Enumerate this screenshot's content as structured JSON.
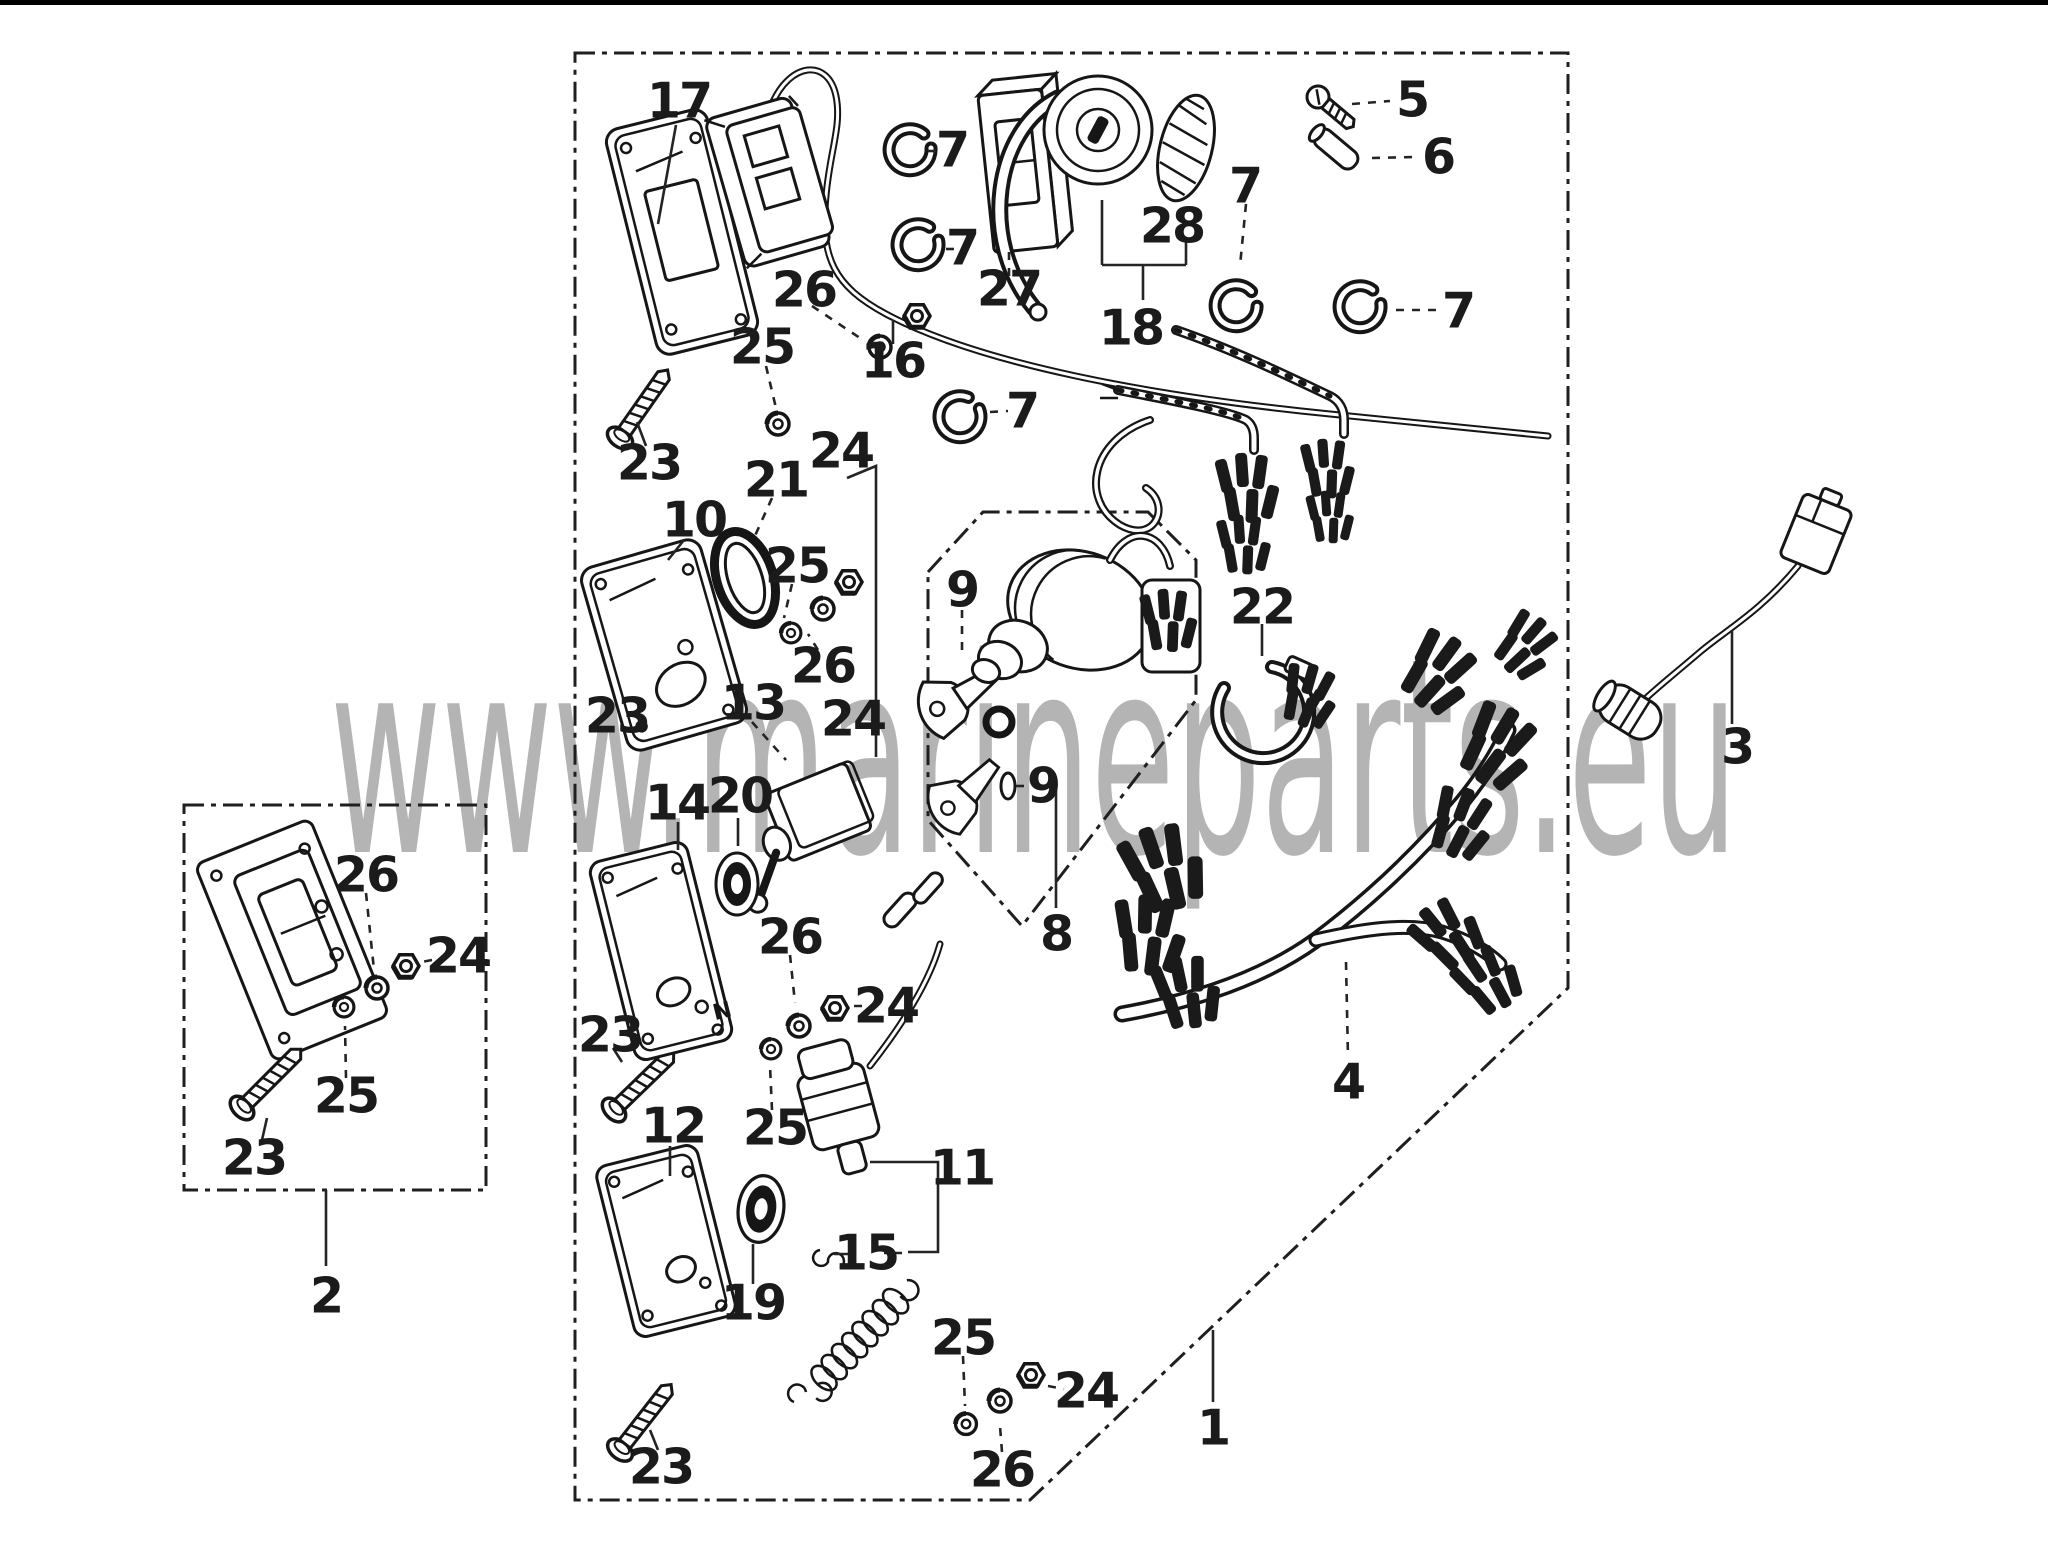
{
  "watermark": {
    "text": "www.marineparts.eu",
    "color": "#b4b4b4"
  },
  "canvas": {
    "background": "#ffffff",
    "line_color": "#161616",
    "width": 2048,
    "height": 1550
  },
  "diagram": {
    "type": "exploded-parts-diagram",
    "subject": "control panel / wire harness exploded view",
    "plate_marking": "N",
    "unique_part_numbers": [
      1,
      2,
      3,
      4,
      5,
      6,
      7,
      8,
      9,
      10,
      11,
      12,
      13,
      14,
      15,
      16,
      17,
      18,
      19,
      20,
      21,
      22,
      23,
      24,
      25,
      26,
      27,
      28
    ],
    "callouts": [
      {
        "label": "17",
        "x": 679,
        "y": 101
      },
      {
        "label": "7",
        "x": 952,
        "y": 150
      },
      {
        "label": "7",
        "x": 962,
        "y": 248
      },
      {
        "label": "7",
        "x": 1022,
        "y": 411
      },
      {
        "label": "7",
        "x": 1245,
        "y": 186
      },
      {
        "label": "7",
        "x": 1458,
        "y": 311
      },
      {
        "label": "5",
        "x": 1412,
        "y": 100
      },
      {
        "label": "6",
        "x": 1438,
        "y": 157
      },
      {
        "label": "26",
        "x": 804,
        "y": 290
      },
      {
        "label": "25",
        "x": 762,
        "y": 347
      },
      {
        "label": "16",
        "x": 893,
        "y": 361
      },
      {
        "label": "24",
        "x": 841,
        "y": 451
      },
      {
        "label": "27",
        "x": 1009,
        "y": 289
      },
      {
        "label": "28",
        "x": 1172,
        "y": 226
      },
      {
        "label": "18",
        "x": 1131,
        "y": 328
      },
      {
        "label": "23",
        "x": 649,
        "y": 463
      },
      {
        "label": "21",
        "x": 776,
        "y": 480
      },
      {
        "label": "10",
        "x": 694,
        "y": 520
      },
      {
        "label": "25",
        "x": 797,
        "y": 566
      },
      {
        "label": "26",
        "x": 823,
        "y": 666
      },
      {
        "label": "24",
        "x": 853,
        "y": 719
      },
      {
        "label": "13",
        "x": 753,
        "y": 703
      },
      {
        "label": "23",
        "x": 617,
        "y": 716
      },
      {
        "label": "9",
        "x": 962,
        "y": 590
      },
      {
        "label": "9",
        "x": 1043,
        "y": 786
      },
      {
        "label": "22",
        "x": 1262,
        "y": 607
      },
      {
        "label": "3",
        "x": 1737,
        "y": 747
      },
      {
        "label": "8",
        "x": 1056,
        "y": 934
      },
      {
        "label": "14",
        "x": 677,
        "y": 803
      },
      {
        "label": "20",
        "x": 740,
        "y": 796
      },
      {
        "label": "26",
        "x": 790,
        "y": 937
      },
      {
        "label": "24",
        "x": 886,
        "y": 1006
      },
      {
        "label": "23",
        "x": 610,
        "y": 1035
      },
      {
        "label": "12",
        "x": 673,
        "y": 1126
      },
      {
        "label": "25",
        "x": 775,
        "y": 1128
      },
      {
        "label": "11",
        "x": 962,
        "y": 1168
      },
      {
        "label": "15",
        "x": 866,
        "y": 1253
      },
      {
        "label": "19",
        "x": 753,
        "y": 1303
      },
      {
        "label": "25",
        "x": 963,
        "y": 1338
      },
      {
        "label": "24",
        "x": 1086,
        "y": 1391
      },
      {
        "label": "4",
        "x": 1348,
        "y": 1082
      },
      {
        "label": "23",
        "x": 661,
        "y": 1467
      },
      {
        "label": "26",
        "x": 1002,
        "y": 1470
      },
      {
        "label": "1",
        "x": 1213,
        "y": 1428
      },
      {
        "label": "2",
        "x": 326,
        "y": 1296
      },
      {
        "label": "26",
        "x": 366,
        "y": 875
      },
      {
        "label": "24",
        "x": 458,
        "y": 956
      },
      {
        "label": "25",
        "x": 346,
        "y": 1096
      },
      {
        "label": "23",
        "x": 254,
        "y": 1158
      }
    ]
  }
}
